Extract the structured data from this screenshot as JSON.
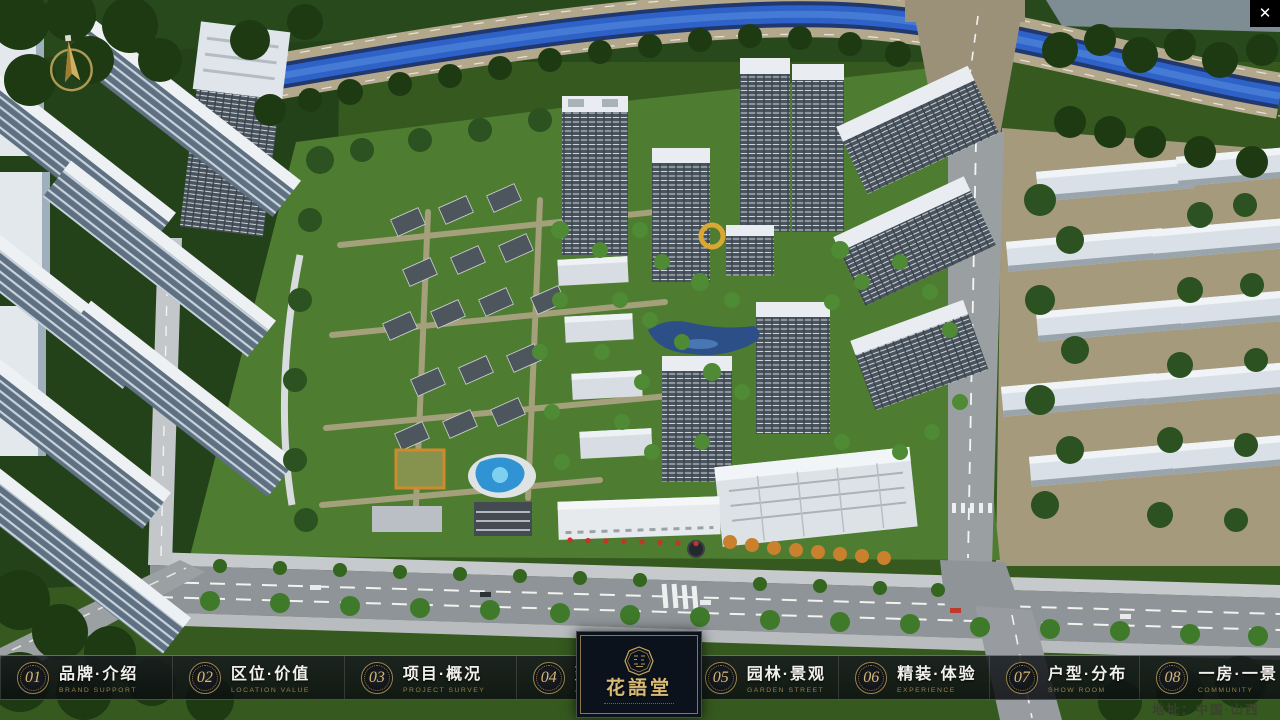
{
  "chrome": {
    "close_glyph": "✕"
  },
  "nav": {
    "items": [
      {
        "number": "01",
        "label_zh": "品牌·介绍",
        "label_en": "BRAND SUPPORT"
      },
      {
        "number": "02",
        "label_zh": "区位·价值",
        "label_en": "LOCATION VALUE"
      },
      {
        "number": "03",
        "label_zh": "项目·概况",
        "label_en": "PROJECT SURVEY"
      },
      {
        "number": "04",
        "label_zh": "建筑·鉴赏",
        "label_en": "APPRECIATION"
      },
      {
        "number": "05",
        "label_zh": "园林·景观",
        "label_en": "GARDEN STREET"
      },
      {
        "number": "06",
        "label_zh": "精装·体验",
        "label_en": "EXPERIENCE"
      },
      {
        "number": "07",
        "label_zh": "户型·分布",
        "label_en": "SHOW ROOM"
      },
      {
        "number": "08",
        "label_zh": "一房·一景",
        "label_en": "COMMUNITY"
      }
    ]
  },
  "logo": {
    "title": "花語堂"
  },
  "footer": {
    "address": "地址：中国·山西"
  },
  "colors": {
    "gold": "#C8A760",
    "gold_dim": "#94804D",
    "bar_background": "#12161A",
    "logo_panel_background": "#0C121B",
    "text_primary": "#F2F1EE",
    "address_text": "#39432C",
    "river_blue": "#2F62C8",
    "map_green": "#35591F"
  }
}
